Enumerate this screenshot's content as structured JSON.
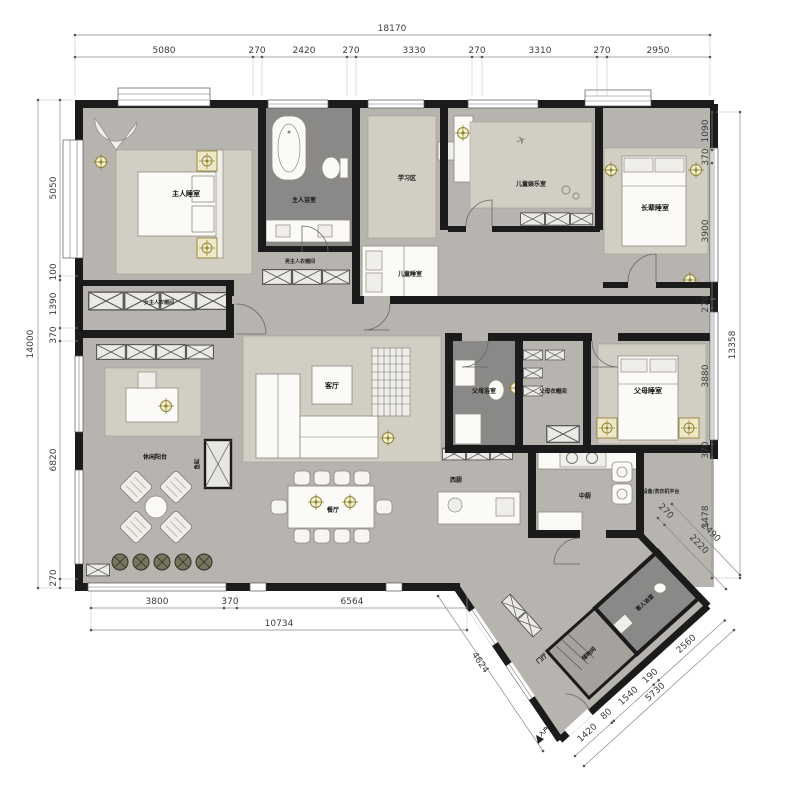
{
  "plan": {
    "labels": {
      "master_bedroom": "主人睡室",
      "master_bath": "主人浴室",
      "male_closet": "男主人衣帽间",
      "female_closet": "女主人衣帽间",
      "study_area": "学习区",
      "children_bedroom": "儿童睡室",
      "children_play": "儿童娱乐室",
      "elder_bedroom": "长辈睡室",
      "parents_bath": "父母浴室",
      "parents_closet": "父母衣帽间",
      "parents_bedroom": "父母睡室",
      "living": "客厅",
      "dining": "餐厅",
      "balcony": "休闲阳台",
      "fish_tank": "鱼缸",
      "west_kitchen": "西厨",
      "kitchen": "中厨",
      "equipment": "设备/洗衣机平台",
      "storage": "储物间",
      "guest_bath": "客人浴室",
      "foyer": "门厅",
      "entry_door": "入户门"
    },
    "dimensions": {
      "top": {
        "total": "18170",
        "segments": [
          "5080",
          "270",
          "2420",
          "270",
          "3330",
          "270",
          "3310",
          "270",
          "2950"
        ]
      },
      "left": {
        "total": "14000",
        "segments": [
          "5050",
          "100",
          "1390",
          "370",
          "6820",
          "270"
        ]
      },
      "right": {
        "total": "13358",
        "segments": [
          "1090",
          "370",
          "3900",
          "270",
          "3880",
          "370",
          "3478"
        ],
        "diagonal": [
          "270",
          "2220",
          "2490"
        ]
      },
      "bottom": {
        "total": "10734",
        "segments": [
          "3800",
          "370",
          "6564"
        ],
        "diagonal": "4624"
      },
      "entry": {
        "total": "5730",
        "segments": [
          "1420",
          "80",
          "1540",
          "190",
          "2560"
        ]
      }
    },
    "colors": {
      "wall": "#1b1b1b",
      "floor": "#b7b4b0",
      "dark_room": "#8b8987",
      "accent_light": "#8f8435"
    }
  }
}
